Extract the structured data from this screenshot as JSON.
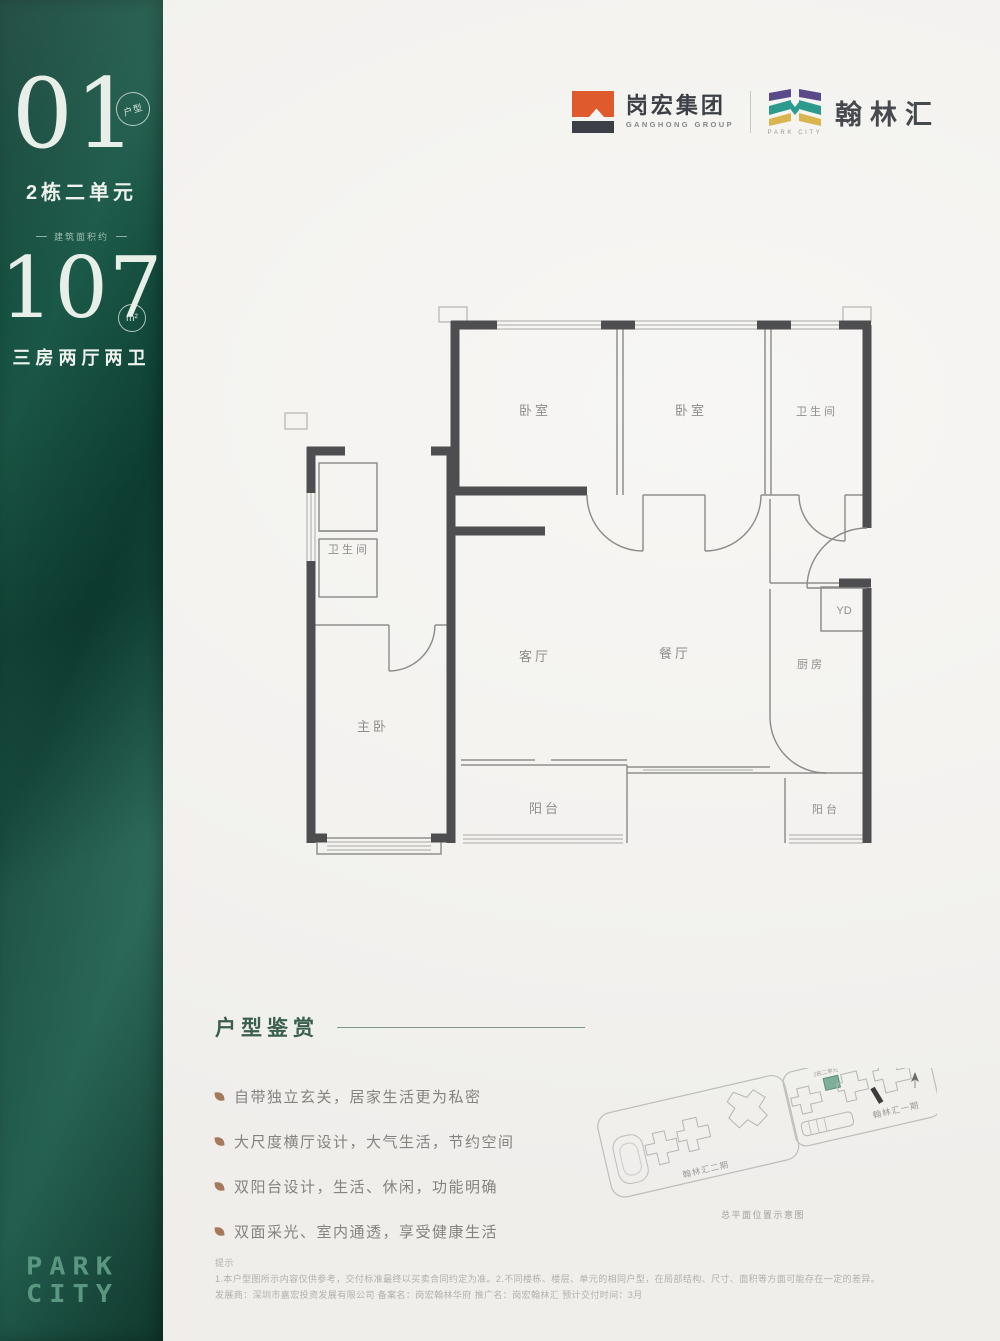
{
  "sidebar": {
    "unit_number": "01",
    "unit_badge": "户型",
    "unit_name": "2栋二单元",
    "area_caption": "建筑面积约",
    "area_value": "107",
    "area_unit": "m²",
    "layout": "三房两厅两卫",
    "brand_line1": "PARK",
    "brand_line2": "CITY"
  },
  "header": {
    "ganghong": {
      "name": "岗宏集团",
      "subtitle": "GANGHONG GROUP"
    },
    "hanlinhui": {
      "name": "翰林汇",
      "subtitle": "PARK CITY"
    }
  },
  "floorplan": {
    "rooms": {
      "bedroom1": "卧室",
      "bedroom2": "卧室",
      "bathroom_top": "卫生间",
      "bathroom_left": "卫生间",
      "master": "主卧",
      "living": "客厅",
      "dining": "餐厅",
      "kitchen": "厨房",
      "duct": "YD",
      "balcony_center": "阳台",
      "balcony_right": "阳台"
    }
  },
  "features": {
    "title": "户型鉴赏",
    "items": [
      "自带独立玄关，居家生活更为私密",
      "大尺度横厅设计，大气生活，节约空间",
      "双阳台设计，生活、休闲，功能明确",
      "双面采光、室内通透，享受健康生活"
    ]
  },
  "sitemap": {
    "phase2_label": "翰林汇二期",
    "phase1_label": "翰林汇一期",
    "building_label": "2栋二单元",
    "building_label2": "2栋四单元",
    "caption": "总平面位置示意图"
  },
  "disclaimer": {
    "title": "提示",
    "line1": "1.本户型图所示内容仅供参考，交付标准最终以买卖合同约定为准。2.不同楼栋、楼层、单元的相同户型，在局部结构、尺寸、面积等方面可能存在一定的差异。",
    "line2": "发展商：深圳市嘉宏投资发展有限公司 备案名：岗宏翰林华府 推广名：岗宏翰林汇 预计交付时间：3月"
  },
  "colors": {
    "sidebar_green": "#1b5948",
    "brand_text": "#5a9781",
    "wall_dark": "#4e4e51",
    "label_gray": "#8d8d8b",
    "title_green": "#3b5f4d",
    "bullet_brown": "#a6795b",
    "logo_orange": "#df5a2c",
    "logo_dark": "#3c4046",
    "mark_purple": "#5a4a8c",
    "mark_teal": "#2d9a8e",
    "mark_yellow": "#d8b54e",
    "highlight_green": "#7fae9b"
  }
}
